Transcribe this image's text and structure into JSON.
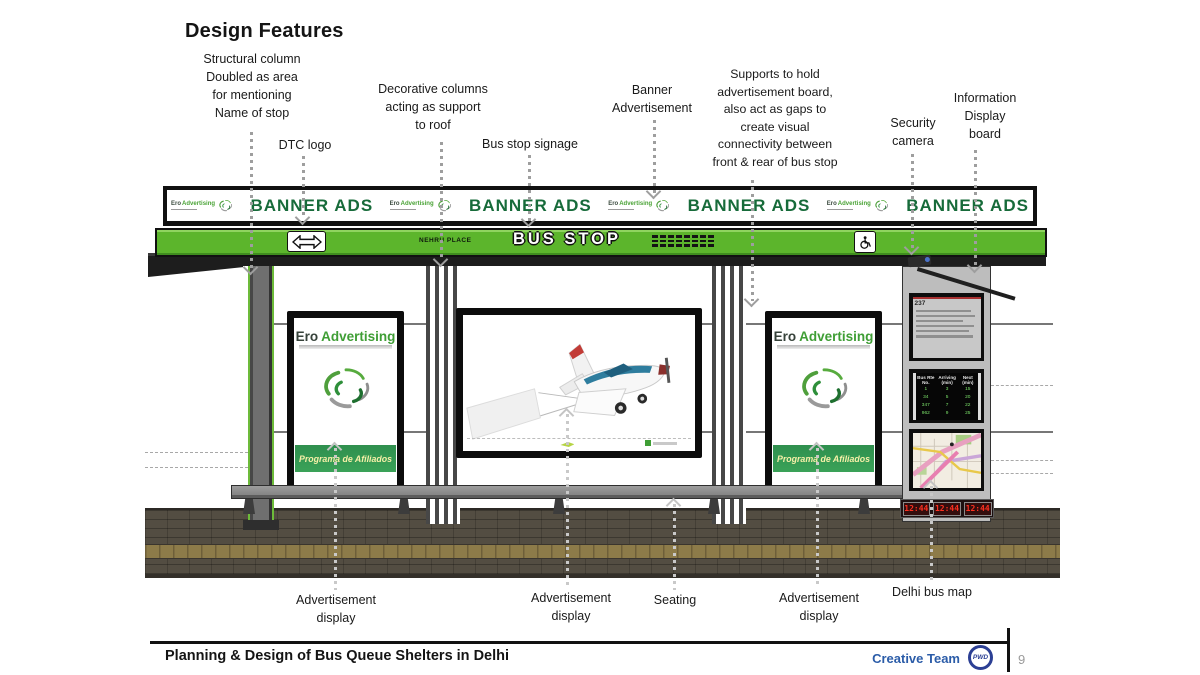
{
  "page": {
    "title": "Design Features"
  },
  "top_annotations": [
    {
      "name": "structural-column",
      "lines": [
        "Structural column",
        "Doubled as area",
        "for mentioning",
        "Name of stop"
      ]
    },
    {
      "name": "dtc-logo",
      "lines": [
        "DTC logo"
      ]
    },
    {
      "name": "decorative-columns",
      "lines": [
        "Decorative columns",
        "acting as support",
        "to roof"
      ]
    },
    {
      "name": "bus-stop-signage",
      "lines": [
        "Bus stop signage"
      ]
    },
    {
      "name": "banner-advertisement",
      "lines": [
        "Banner",
        "Advertisement"
      ]
    },
    {
      "name": "supports",
      "lines": [
        "Supports  to hold",
        "advertisement board,",
        "also act as gaps to",
        "create visual",
        "connectivity between",
        "front &  rear of bus stop"
      ]
    },
    {
      "name": "security-camera",
      "lines": [
        "Security",
        "camera"
      ]
    },
    {
      "name": "information-display-board",
      "lines": [
        "Information",
        "Display",
        "board"
      ]
    }
  ],
  "bottom_annotations": [
    {
      "name": "advertisement-display-left",
      "lines": [
        "Advertisement",
        "display"
      ]
    },
    {
      "name": "advertisement-display-center",
      "lines": [
        "Advertisement",
        "display"
      ]
    },
    {
      "name": "seating",
      "lines": [
        "Seating"
      ]
    },
    {
      "name": "advertisement-display-right",
      "lines": [
        "Advertisement",
        "display"
      ]
    },
    {
      "name": "delhi-bus-map",
      "lines": [
        "Delhi bus map"
      ]
    }
  ],
  "shelter": {
    "banner": {
      "ad_text": "BANNER ADS"
    },
    "brand": {
      "a": "Ero",
      "b": "Advertising"
    },
    "strip": {
      "stop_name": "NEHRU PLACE",
      "bus_stop_text": "BUS STOP"
    },
    "ad_panel": {
      "footer_text": "Programa de Afiliados"
    },
    "kiosk": {
      "schedule_no": "237",
      "arrivals": {
        "headers": [
          "Bus Rte No.",
          "Arriving (min)",
          "Next (min)"
        ],
        "rows": [
          [
            "1",
            "3",
            "15"
          ],
          [
            "34",
            "5",
            "20"
          ],
          [
            "347",
            "7",
            "22"
          ],
          [
            "962",
            "9",
            "25"
          ]
        ]
      },
      "clock_times": [
        "12:44",
        "12:44",
        "12:44"
      ]
    }
  },
  "footer": {
    "title": "Planning & Design of Bus Queue Shelters in Delhi",
    "credit": "Creative Team",
    "logo": "PWD",
    "page_number": "9"
  },
  "colors": {
    "green": "#5cb52c",
    "dark_green_text": "#176b3a",
    "footer_blue": "#2b5ca8",
    "led_red": "#ff3020"
  }
}
